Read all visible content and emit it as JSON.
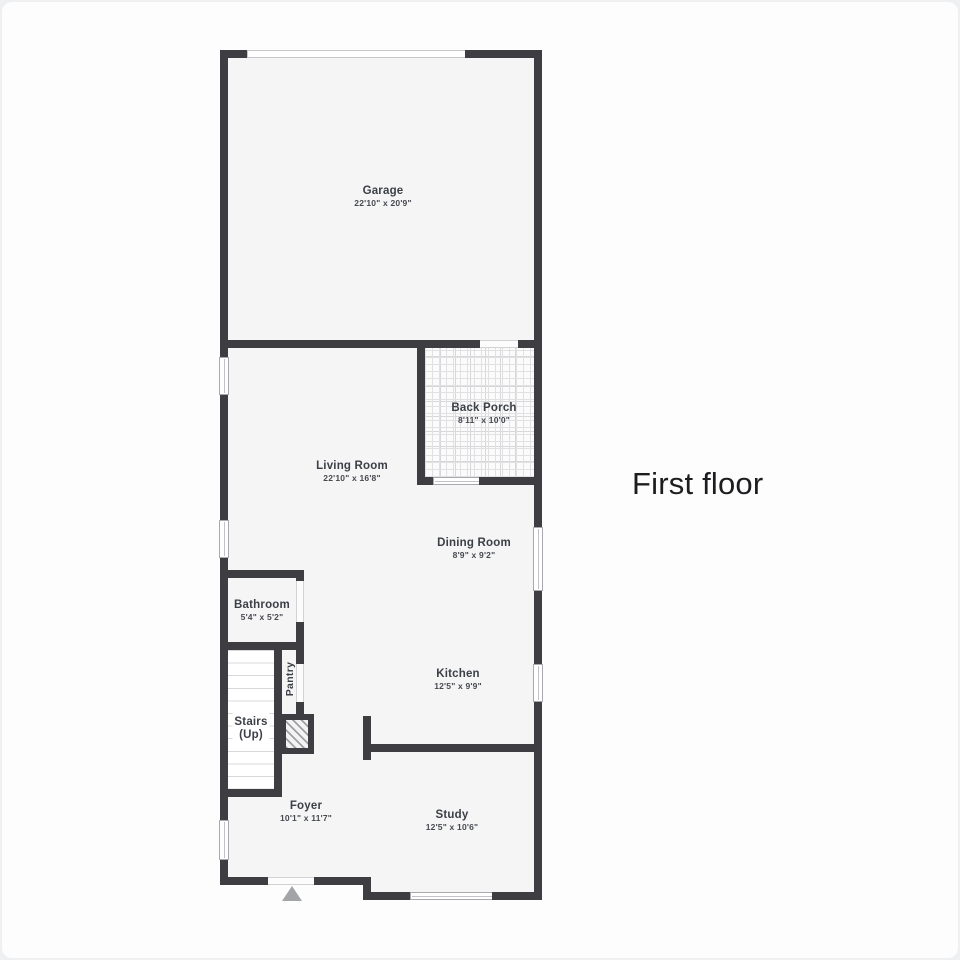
{
  "page": {
    "title": "First floor"
  },
  "floorplan": {
    "wall_color": "#3d3d42",
    "floor_color": "#f5f5f6",
    "rooms": [
      {
        "id": "garage",
        "name": "Garage",
        "dims": "22'10\" x 20'9\""
      },
      {
        "id": "back-porch",
        "name": "Back Porch",
        "dims": "8'11\" x 10'0\""
      },
      {
        "id": "living-room",
        "name": "Living Room",
        "dims": "22'10\" x 16'8\""
      },
      {
        "id": "dining-room",
        "name": "Dining Room",
        "dims": "8'9\" x 9'2\""
      },
      {
        "id": "bathroom",
        "name": "Bathroom",
        "dims": "5'4\" x 5'2\""
      },
      {
        "id": "kitchen",
        "name": "Kitchen",
        "dims": "12'5\" x 9'9\""
      },
      {
        "id": "foyer",
        "name": "Foyer",
        "dims": "10'1\" x 11'7\""
      },
      {
        "id": "study",
        "name": "Study",
        "dims": "12'5\" x 10'6\""
      }
    ],
    "stairs": {
      "line1": "Stairs",
      "line2": "(Up)"
    },
    "pantry_label": "Pantry"
  }
}
